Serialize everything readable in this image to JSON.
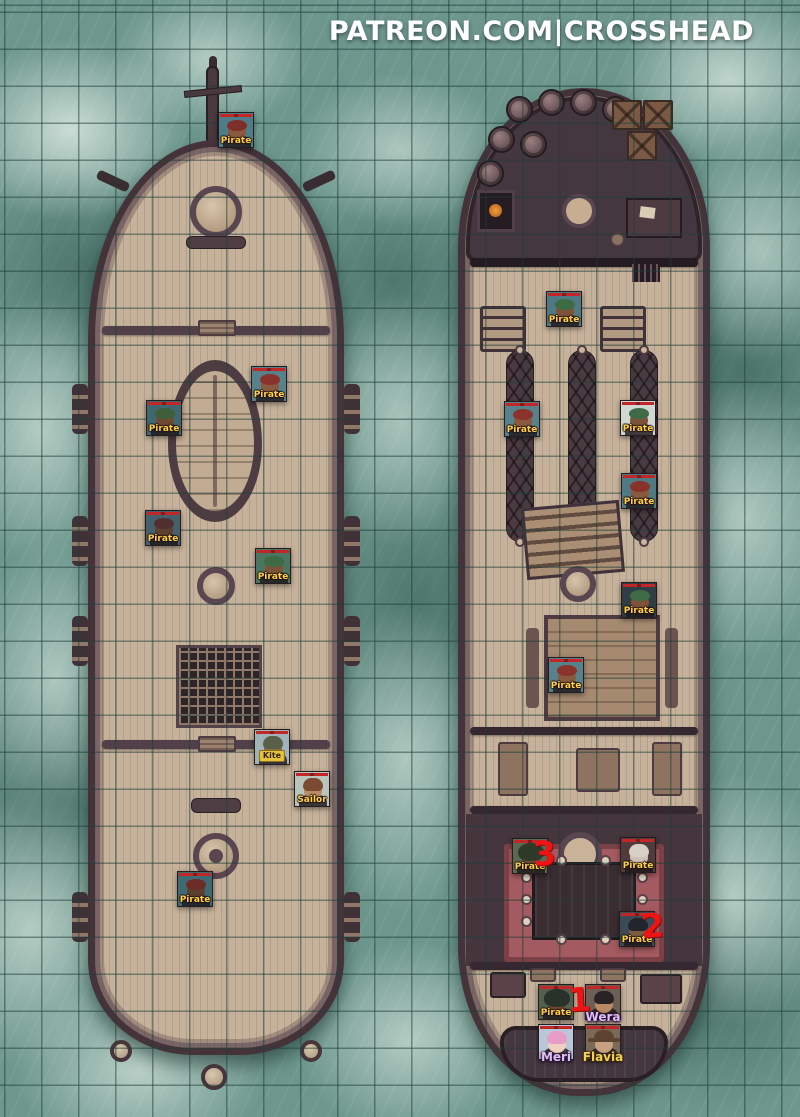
{
  "header": {
    "watermark": "PATREON.COM|CROSSHEAD"
  },
  "map": {
    "grid_size_px": 37,
    "colors": {
      "water": "#6d978d",
      "grid_line": "#2b5a52",
      "foam": "#dbe8e1",
      "hull": "#44343a",
      "deck": "#c6b29b",
      "deck_dark": "#453740",
      "carpet": "#a35a60",
      "marker_red": "#ee1414",
      "hp_bar_red": "#c22626",
      "npc_label_yellow": "#ffd24a"
    }
  },
  "tokens": [
    {
      "label": "Pirate",
      "x": 218,
      "y": 112,
      "style": "npc",
      "hat": "bandana",
      "colors": {
        "bg": "#4e7d87",
        "skin": "#8a5a3f",
        "hat": "#7e2f2a"
      }
    },
    {
      "label": "Pirate",
      "x": 251,
      "y": 366,
      "style": "npc",
      "hat": "bandana",
      "colors": {
        "bg": "#57828c",
        "skin": "#8a5a3f",
        "hat": "#8a332c"
      }
    },
    {
      "label": "Pirate",
      "x": 146,
      "y": 400,
      "style": "npc",
      "hat": "bandana",
      "colors": {
        "bg": "#3f6770",
        "skin": "#6e4a33",
        "hat": "#3f5f3a"
      }
    },
    {
      "label": "Pirate",
      "x": 145,
      "y": 510,
      "style": "npc",
      "hat": "bandana",
      "colors": {
        "bg": "#44606c",
        "skin": "#5d4030",
        "hat": "#512f2e"
      }
    },
    {
      "label": "Pirate",
      "x": 255,
      "y": 548,
      "style": "npc",
      "hat": "bandana",
      "colors": {
        "bg": "#4a7560",
        "skin": "#7e5238",
        "hat": "#3e6b46"
      }
    },
    {
      "label": "Kite",
      "x": 254,
      "y": 729,
      "style": "chip",
      "hat": "hair",
      "colors": {
        "bg": "#9fb3b8",
        "skin": "#8a6a4c",
        "hat": "#5a5f4a"
      }
    },
    {
      "label": "Sailor",
      "x": 294,
      "y": 771,
      "style": "npc",
      "hat": "hair",
      "colors": {
        "bg": "#b9c4bb",
        "skin": "#b98a66",
        "hat": "#7a4a33"
      }
    },
    {
      "label": "Pirate",
      "x": 177,
      "y": 871,
      "style": "npc",
      "hat": "bandana",
      "colors": {
        "bg": "#3e6a74",
        "skin": "#5d3f2f",
        "hat": "#6e2c28"
      }
    },
    {
      "label": "Pirate",
      "x": 546,
      "y": 291,
      "style": "npc",
      "hat": "bandana",
      "colors": {
        "bg": "#4f7a84",
        "skin": "#7e5238",
        "hat": "#3e6b46"
      }
    },
    {
      "label": "Pirate",
      "x": 504,
      "y": 401,
      "style": "npc",
      "hat": "bandana",
      "colors": {
        "bg": "#57828c",
        "skin": "#8a5a3f",
        "hat": "#8a332c"
      }
    },
    {
      "label": "Pirate",
      "x": 620,
      "y": 400,
      "style": "npc",
      "hat": "bandana",
      "colors": {
        "bg": "#cfd8d2",
        "skin": "#7e5238",
        "hat": "#3e6b46"
      }
    },
    {
      "label": "Pirate",
      "x": 621,
      "y": 473,
      "style": "npc",
      "hat": "bandana",
      "colors": {
        "bg": "#4f7a84",
        "skin": "#8a5a3f",
        "hat": "#8a332c"
      }
    },
    {
      "label": "Pirate",
      "x": 621,
      "y": 582,
      "style": "npc",
      "hat": "bandana",
      "colors": {
        "bg": "#2e3e44",
        "skin": "#7e5238",
        "hat": "#3e6b46"
      }
    },
    {
      "label": "Pirate",
      "x": 548,
      "y": 657,
      "style": "npc",
      "hat": "bandana",
      "colors": {
        "bg": "#57828c",
        "skin": "#8a5a3f",
        "hat": "#8a332c"
      }
    },
    {
      "label": "Pirate",
      "x": 512,
      "y": 838,
      "style": "npc",
      "hat": "hood",
      "colors": {
        "bg": "#5a6a50",
        "skin": "#6e4a33",
        "hat": "#2e3a2a"
      }
    },
    {
      "label": "Pirate",
      "x": 620,
      "y": 837,
      "style": "npc",
      "hat": "hair",
      "colors": {
        "bg": "#503a3a",
        "skin": "#cfc0b8",
        "hat": "#d8cfc6"
      }
    },
    {
      "label": "Pirate",
      "x": 619,
      "y": 911,
      "style": "npc",
      "hat": "hair",
      "colors": {
        "bg": "#3a4a56",
        "skin": "#7e5a42",
        "hat": "#22262c"
      }
    },
    {
      "label": "Pirate",
      "x": 538,
      "y": 984,
      "style": "npc",
      "hat": "hood",
      "colors": {
        "bg": "#54604e",
        "skin": "#6e4a33",
        "hat": "#28322a"
      }
    },
    {
      "label": "Wera",
      "x": 585,
      "y": 984,
      "style": "name-purple",
      "hat": "hair",
      "colors": {
        "bg": "#6e5f56",
        "skin": "#b98a66",
        "hat": "#2a2326"
      }
    },
    {
      "label": "Meri",
      "x": 538,
      "y": 1024,
      "style": "name-purple",
      "hat": "hair",
      "colors": {
        "bg": "#b8c8d8",
        "skin": "#f0d0c0",
        "hat": "#e89cc8"
      }
    },
    {
      "label": "Flavia",
      "x": 585,
      "y": 1024,
      "style": "name-yellow",
      "hat": "brim",
      "colors": {
        "bg": "#7a6a58",
        "skin": "#caa083",
        "hat": "#5f4332"
      }
    }
  ],
  "markers": [
    {
      "text": "3",
      "x": 533,
      "y": 834
    },
    {
      "text": "2",
      "x": 641,
      "y": 906
    },
    {
      "text": "1",
      "x": 568,
      "y": 980
    }
  ]
}
